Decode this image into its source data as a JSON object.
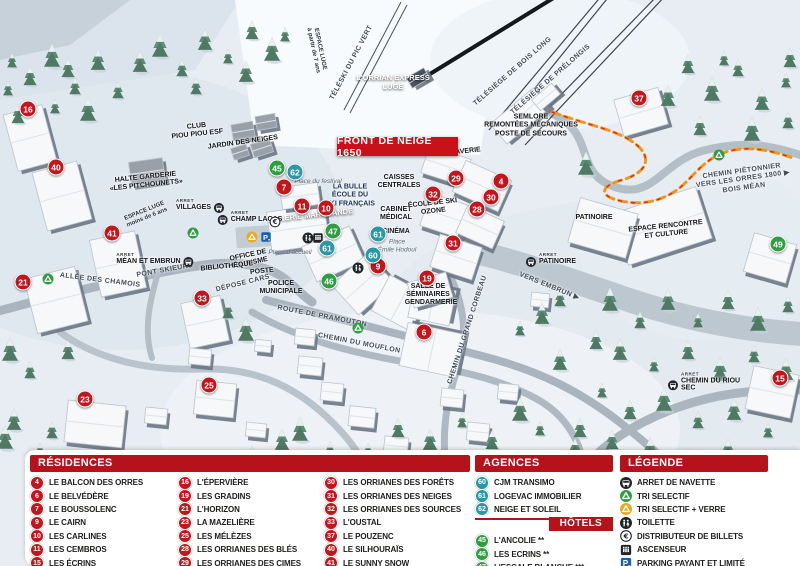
{
  "banner": {
    "text": "FRONT DE NEIGE 1650"
  },
  "colors": {
    "header_red": "#b5121b",
    "banner_red": "#c9111a",
    "residence_red": "#c3161c",
    "hotel_green": "#2f9e41",
    "agence_teal": "#2798a6",
    "parking_blue": "#1660b4",
    "recycle_green": "#2f9e41",
    "recycle_yellow": "#efa71c"
  },
  "legend_panels": {
    "residences": {
      "title": "RÉSIDENCES",
      "columns": [
        [
          {
            "num": "4",
            "label": "LE BALCON DES ORRES"
          },
          {
            "num": "6",
            "label": "LE BELVÉDÈRE"
          },
          {
            "num": "7",
            "label": "LE BOUSSOLENC"
          },
          {
            "num": "9",
            "label": "LE CAIRN"
          },
          {
            "num": "10",
            "label": "LES CARLINES"
          },
          {
            "num": "11",
            "label": "LES CEMBROS"
          },
          {
            "num": "15",
            "label": "LES ÉCRINS"
          }
        ],
        [
          {
            "num": "16",
            "label": "L'ÉPERVIÈRE"
          },
          {
            "num": "19",
            "label": "LES GRADINS"
          },
          {
            "num": "21",
            "label": "L'HORIZON"
          },
          {
            "num": "23",
            "label": "LA MAZELIÈRE"
          },
          {
            "num": "25",
            "label": "LES MÉLÈZES"
          },
          {
            "num": "28",
            "label": "LES ORRIANES DES BLÉS"
          },
          {
            "num": "29",
            "label": "LES ORRIANES DES CIMES"
          }
        ],
        [
          {
            "num": "30",
            "label": "LES ORRIANES DES FORÊTS"
          },
          {
            "num": "31",
            "label": "LES ORRIANES DES NEIGES"
          },
          {
            "num": "32",
            "label": "LES ORRIANES DES SOURCES"
          },
          {
            "num": "33",
            "label": "L'OUSTAL"
          },
          {
            "num": "37",
            "label": "LE POUZENC"
          },
          {
            "num": "40",
            "label": "LE SILHOURAÏS"
          },
          {
            "num": "41",
            "label": "LE SUNNY SNOW"
          }
        ]
      ]
    },
    "agences": {
      "title": "AGENCES IMMOBILIÈRES",
      "items": [
        {
          "num": "60",
          "label": "CJM TRANSIMO"
        },
        {
          "num": "61",
          "label": "LOGEVAC IMMOBILIER"
        },
        {
          "num": "62",
          "label": "NEIGE ET SOLEIL"
        }
      ]
    },
    "hotels": {
      "title": "HÔTELS",
      "items": [
        {
          "num": "45",
          "label": "L'ANCOLIE **"
        },
        {
          "num": "46",
          "label": "LES ECRINS **"
        },
        {
          "num": "47",
          "label": "L'ESCALE BLANCHE ***"
        },
        {
          "num": "49",
          "label": "LES TRAPPEURS **"
        }
      ]
    },
    "legende": {
      "title": "LÉGENDE",
      "items": [
        {
          "icon": "bus",
          "label": "ARRET DE NAVETTE"
        },
        {
          "icon": "recycle-green",
          "label": "TRI SELECTIF"
        },
        {
          "icon": "recycle-yellow",
          "label": "TRI SELECTIF + VERRE"
        },
        {
          "icon": "toilet",
          "label": "TOILETTE"
        },
        {
          "icon": "euro",
          "label": "DISTRIBUTEUR DE BILLETS"
        },
        {
          "icon": "elevator",
          "label": "ASCENSEUR"
        },
        {
          "icon": "parking",
          "label": "PARKING PAYANT ET LIMITÉ"
        }
      ]
    }
  },
  "map": {
    "arret_prefix": "ARRET",
    "markers": [
      {
        "num": "16",
        "cat": "res",
        "x": 28,
        "y": 109
      },
      {
        "num": "40",
        "cat": "res",
        "x": 56,
        "y": 167
      },
      {
        "num": "41",
        "cat": "res",
        "x": 112,
        "y": 233
      },
      {
        "num": "21",
        "cat": "res",
        "x": 23,
        "y": 282
      },
      {
        "num": "33",
        "cat": "res",
        "x": 202,
        "y": 298
      },
      {
        "num": "23",
        "cat": "res",
        "x": 85,
        "y": 399
      },
      {
        "num": "25",
        "cat": "res",
        "x": 209,
        "y": 385
      },
      {
        "num": "7",
        "cat": "res",
        "x": 284,
        "y": 187
      },
      {
        "num": "11",
        "cat": "res",
        "x": 302,
        "y": 206
      },
      {
        "num": "10",
        "cat": "res",
        "x": 326,
        "y": 208
      },
      {
        "num": "9",
        "cat": "res",
        "x": 378,
        "y": 266
      },
      {
        "num": "29",
        "cat": "res",
        "x": 456,
        "y": 178
      },
      {
        "num": "32",
        "cat": "res",
        "x": 433,
        "y": 194
      },
      {
        "num": "4",
        "cat": "res",
        "x": 501,
        "y": 181
      },
      {
        "num": "30",
        "cat": "res",
        "x": 491,
        "y": 197
      },
      {
        "num": "28",
        "cat": "res",
        "x": 477,
        "y": 209
      },
      {
        "num": "31",
        "cat": "res",
        "x": 453,
        "y": 243
      },
      {
        "num": "19",
        "cat": "res",
        "x": 427,
        "y": 278
      },
      {
        "num": "6",
        "cat": "res",
        "x": 424,
        "y": 332
      },
      {
        "num": "37",
        "cat": "res",
        "x": 639,
        "y": 98
      },
      {
        "num": "15",
        "cat": "res",
        "x": 780,
        "y": 378
      },
      {
        "num": "45",
        "cat": "hotel",
        "x": 277,
        "y": 168
      },
      {
        "num": "47",
        "cat": "hotel",
        "x": 333,
        "y": 231
      },
      {
        "num": "46",
        "cat": "hotel",
        "x": 329,
        "y": 281
      },
      {
        "num": "49",
        "cat": "hotel",
        "x": 778,
        "y": 244
      },
      {
        "num": "62",
        "cat": "agence",
        "x": 295,
        "y": 172
      },
      {
        "num": "61",
        "cat": "agence",
        "x": 327,
        "y": 248
      },
      {
        "num": "61",
        "cat": "agence",
        "x": 378,
        "y": 234
      },
      {
        "num": "60",
        "cat": "agence",
        "x": 373,
        "y": 255
      }
    ],
    "labels": [
      {
        "name": "espace-luge-7ans",
        "lines": [
          "ESPACE LUGE",
          "à partir de 7 ans"
        ],
        "x": 316,
        "y": 50,
        "rot": 78,
        "cls": "tiny"
      },
      {
        "name": "teleski-pic-vert",
        "text": "TÉLÉSKI DU PIC VERT",
        "x": 352,
        "y": 63,
        "rot": -62,
        "cls": "road"
      },
      {
        "name": "orrian-express",
        "lines": [
          "L'ORRIAN EXPRESS",
          "LUGE"
        ],
        "x": 393,
        "y": 83,
        "rot": 0,
        "cls": "white-label"
      },
      {
        "name": "telesiege-bois-long",
        "text": "TÉLÉSIÈGE DE BOIS LONG",
        "x": 513,
        "y": 72,
        "rot": -41,
        "cls": "road"
      },
      {
        "name": "telesiege-prelongis",
        "text": "TÉLÉSIÈGE DE PRÉLONGIS",
        "x": 551,
        "y": 80,
        "rot": -41,
        "cls": "road"
      },
      {
        "name": "semlore",
        "lines": [
          "SEMLORE",
          "REMONTÉES MÉCANIQUES",
          "POSTE DE SECOURS"
        ],
        "x": 531,
        "y": 126,
        "rot": 0,
        "cls": "place"
      },
      {
        "name": "club-piou-piou",
        "lines": [
          "CLUB",
          "PIOU PIOU ESF"
        ],
        "x": 197,
        "y": 131,
        "rot": -6,
        "cls": "place"
      },
      {
        "name": "jardin-des-neiges",
        "text": "JARDIN DES NEIGES",
        "x": 243,
        "y": 143,
        "rot": -8,
        "cls": "place"
      },
      {
        "name": "halte-garderie",
        "lines": [
          "HALTE GARDERIE",
          "«LES PITCHOUNETS»"
        ],
        "x": 146,
        "y": 182,
        "rot": -6,
        "cls": "place"
      },
      {
        "name": "espace-luge-6ans",
        "lines": [
          "ESPACE LUGE",
          "moins de 6 ans"
        ],
        "x": 146,
        "y": 215,
        "rot": -22,
        "cls": "tiny"
      },
      {
        "name": "la-bulle-esf",
        "lines": [
          "LA BULLE",
          "ÉCOLE DU",
          "SKI FRANÇAIS"
        ],
        "x": 350,
        "y": 196,
        "rot": 0,
        "cls": "navy"
      },
      {
        "name": "place-du-festival",
        "text": "Place du festival",
        "x": 318,
        "y": 182,
        "rot": 0,
        "cls": "italic"
      },
      {
        "name": "galerie-marchande",
        "text": "GALERIE MARCHANDE",
        "x": 311,
        "y": 216,
        "rot": -6,
        "cls": "white-label"
      },
      {
        "name": "caisses-centrales",
        "lines": [
          "CAISSES",
          "CENTRALES"
        ],
        "x": 399,
        "y": 182,
        "rot": 0,
        "cls": "place"
      },
      {
        "name": "cabinet-medical",
        "lines": [
          "CABINET",
          "MÉDICAL"
        ],
        "x": 396,
        "y": 214,
        "rot": 0,
        "cls": "place"
      },
      {
        "name": "cinema",
        "text": "CINÉMA",
        "x": 396,
        "y": 232,
        "rot": 0,
        "cls": "place"
      },
      {
        "name": "place-emile-hodoul",
        "lines": [
          "Place",
          "Émile Hodoul"
        ],
        "x": 397,
        "y": 246,
        "rot": 0,
        "cls": "italic"
      },
      {
        "name": "ecole-ski-ozone",
        "lines": [
          "ÉCOLE DE SKI",
          "OZONE"
        ],
        "x": 433,
        "y": 208,
        "rot": -6,
        "cls": "place"
      },
      {
        "name": "laverie",
        "text": "LAVERIE",
        "x": 466,
        "y": 152,
        "rot": -6,
        "cls": "place"
      },
      {
        "name": "office-de-tourisme",
        "lines": [
          "OFFICE DE",
          "TOURISME"
        ],
        "x": 249,
        "y": 260,
        "rot": -12,
        "cls": "place"
      },
      {
        "name": "bibliotheque",
        "text": "BIBLIOTHÈQUE",
        "x": 227,
        "y": 267,
        "rot": -6,
        "cls": "place"
      },
      {
        "name": "poste",
        "text": "POSTE",
        "x": 262,
        "y": 272,
        "rot": -6,
        "cls": "place"
      },
      {
        "name": "depose-cars",
        "text": "DÉPOSE CARS",
        "x": 243,
        "y": 284,
        "rot": -14,
        "cls": "road"
      },
      {
        "name": "police-municipale",
        "lines": [
          "POLICE",
          "MUNICIPALE"
        ],
        "x": 281,
        "y": 288,
        "rot": 0,
        "cls": "place"
      },
      {
        "name": "place-accueil",
        "text": "Place d'accueil",
        "x": 290,
        "y": 253,
        "rot": 0,
        "cls": "italic"
      },
      {
        "name": "allee-des-chamois",
        "text": "ALLÉE DES CHAMOIS",
        "x": 100,
        "y": 281,
        "rot": 7,
        "cls": "road"
      },
      {
        "name": "pont-skieurs",
        "text": "PONT SKIEURS",
        "x": 165,
        "y": 271,
        "rot": -10,
        "cls": "road"
      },
      {
        "name": "route-de-pramouton",
        "text": "ROUTE DE PRAMOUTON",
        "x": 322,
        "y": 317,
        "rot": 11,
        "cls": "road"
      },
      {
        "name": "chemin-du-mouflon",
        "text": "CHEMIN DU MOUFLON",
        "x": 359,
        "y": 344,
        "rot": 11,
        "cls": "road"
      },
      {
        "name": "chemin-du-grand-corbeau",
        "text": "CHEMIN DU GRAND CORBEAU",
        "x": 468,
        "y": 330,
        "rot": -72,
        "cls": "road"
      },
      {
        "name": "salle-de-seminaires",
        "lines": [
          "SALLE DE",
          "SÉMINAIRES"
        ],
        "x": 428,
        "y": 291,
        "rot": 0,
        "cls": "place"
      },
      {
        "name": "gendarmerie",
        "text": "GENDARMERIE",
        "x": 431,
        "y": 303,
        "rot": 0,
        "cls": "place"
      },
      {
        "name": "vers-embrun",
        "text": "VERS EMBRUN ▶",
        "x": 549,
        "y": 287,
        "rot": 22,
        "cls": "road"
      },
      {
        "name": "patinoire",
        "text": "PATINOIRE",
        "x": 594,
        "y": 218,
        "rot": 0,
        "cls": "place"
      },
      {
        "name": "espace-rencontre",
        "lines": [
          "ESPACE RENCONTRE",
          "ET CULTURE"
        ],
        "x": 666,
        "y": 231,
        "rot": -6,
        "cls": "place"
      },
      {
        "name": "chemin-pietonnier",
        "lines": [
          "CHEMIN PIÉTONNIER",
          "VERS LES ORRES 1800 ▶",
          "BOIS MÉAN"
        ],
        "x": 743,
        "y": 180,
        "rot": -8,
        "cls": "road"
      },
      {
        "name": "villages",
        "text": "VILLAGES",
        "x": 0,
        "y": 0,
        "rot": 0,
        "cls": "place",
        "hidden": true
      }
    ],
    "bus_stops": [
      {
        "name": "VILLAGES",
        "x": 200,
        "y": 205,
        "icon_side": "right"
      },
      {
        "name": "CHAMP LACAS",
        "x": 250,
        "y": 217,
        "icon_side": "left"
      },
      {
        "name": "MÉAN ET EMBRUN",
        "x": 155,
        "y": 259,
        "icon_side": "right"
      },
      {
        "name": "PATINOIRE",
        "x": 551,
        "y": 259,
        "icon_side": "left"
      },
      {
        "name": "CHEMIN DU RIOU SEC",
        "x": 712,
        "y": 382,
        "icon_side": "left"
      }
    ],
    "icons": [
      {
        "type": "recycle-green",
        "x": 48,
        "y": 279
      },
      {
        "type": "recycle-green",
        "x": 193,
        "y": 233
      },
      {
        "type": "recycle-green",
        "x": 358,
        "y": 328
      },
      {
        "type": "recycle-green",
        "x": 719,
        "y": 155
      },
      {
        "type": "recycle-yellow",
        "x": 252,
        "y": 237
      },
      {
        "type": "parking",
        "x": 266,
        "y": 237
      },
      {
        "type": "euro",
        "x": 275,
        "y": 222
      },
      {
        "type": "toilet",
        "x": 308,
        "y": 238
      },
      {
        "type": "elevator",
        "x": 318,
        "y": 238
      },
      {
        "type": "toilet",
        "x": 358,
        "y": 268
      }
    ]
  }
}
